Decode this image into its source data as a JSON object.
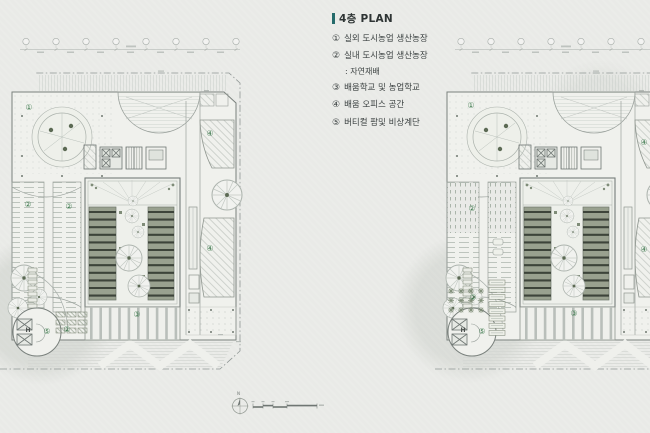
{
  "legend": {
    "title": "4층 PLAN",
    "items": [
      {
        "num": "①",
        "label": "실외 도시농업 생산농장"
      },
      {
        "num": "②",
        "label": "실내 도시농업 생산농장",
        "note": ": 자연재배"
      },
      {
        "num": "③",
        "label": "배움학교 및 농업학교"
      },
      {
        "num": "④",
        "label": "배움 오피스 공간"
      },
      {
        "num": "⑤",
        "label": "버티컬 팜및 비상계단"
      }
    ]
  },
  "plans": {
    "left": {
      "name": "site-plan-left",
      "markers": [
        {
          "t": "①",
          "x": 21,
          "y": 73
        },
        {
          "t": "②",
          "x": 20,
          "y": 170
        },
        {
          "t": "②",
          "x": 61,
          "y": 172
        },
        {
          "t": "②",
          "x": 59,
          "y": 295
        },
        {
          "t": "③",
          "x": 129,
          "y": 280
        },
        {
          "t": "④",
          "x": 202,
          "y": 99
        },
        {
          "t": "④",
          "x": 202,
          "y": 214
        },
        {
          "t": "⑤",
          "x": 39,
          "y": 297
        },
        {
          "t": "H",
          "x": 20,
          "y": 296,
          "letter": true
        }
      ]
    },
    "right": {
      "name": "site-plan-right",
      "markers": [
        {
          "t": "①",
          "x": 28,
          "y": 71
        },
        {
          "t": "②",
          "x": 29,
          "y": 174
        },
        {
          "t": "②",
          "x": 30,
          "y": 263
        },
        {
          "t": "③",
          "x": 131,
          "y": 279
        },
        {
          "t": "④",
          "x": 201,
          "y": 108
        },
        {
          "t": "④",
          "x": 201,
          "y": 215
        },
        {
          "t": "⑤",
          "x": 39,
          "y": 297
        },
        {
          "t": "H",
          "x": 20,
          "y": 296,
          "letter": true
        }
      ]
    }
  },
  "scalebar": {
    "north": "N"
  },
  "colors": {
    "paper": "#e9eae7",
    "accent_teal": "#256b6b",
    "marker_green": "#3e7a4e",
    "bed_green": "#99a18f",
    "bed_stripe": "#3d443a",
    "line_gray": "#8f968f"
  }
}
